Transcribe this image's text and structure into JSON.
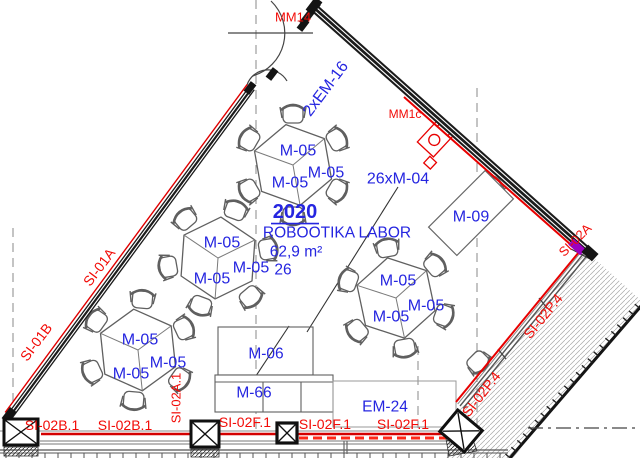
{
  "drawing_type": "architectural-floor-plan",
  "room": {
    "number": "2020",
    "name": "ROBOOTIKA LABOR",
    "area": "62,9 m²",
    "capacity": "26"
  },
  "colors": {
    "blue": "#2525e0",
    "red": "#f20b07",
    "redline": "#e00000",
    "wall": "#1b1b1b",
    "thin": "#5f5f5f",
    "grid": "#8a8a8a",
    "purple": "#9b00c0"
  },
  "labels": [
    {
      "text": "MM14",
      "x": 293,
      "y": 17,
      "rot": 0,
      "color": "red",
      "size": 13
    },
    {
      "text": "2xEM-16",
      "x": 326,
      "y": 89,
      "rot": -53,
      "color": "blue",
      "size": 16
    },
    {
      "text": "MM1c",
      "x": 405,
      "y": 114,
      "rot": 0,
      "color": "red",
      "size": 12
    },
    {
      "text": "M-05",
      "x": 298,
      "y": 151,
      "rot": 0,
      "color": "blue",
      "size": 16
    },
    {
      "text": "M-05",
      "x": 326,
      "y": 173,
      "rot": 0,
      "color": "blue",
      "size": 16
    },
    {
      "text": "M-05",
      "x": 290,
      "y": 183,
      "rot": 0,
      "color": "blue",
      "size": 16
    },
    {
      "text": "26xM-04",
      "x": 398,
      "y": 179,
      "rot": 0,
      "color": "blue",
      "size": 16
    },
    {
      "text": "M-09",
      "x": 471,
      "y": 217,
      "rot": 0,
      "color": "blue",
      "size": 16
    },
    {
      "text": "2020",
      "x": 295,
      "y": 212,
      "rot": 0,
      "color": "blue",
      "size": 20,
      "bold": true,
      "underline": true
    },
    {
      "text": "ROBOOTIKA LABOR",
      "x": 337,
      "y": 233,
      "rot": 0,
      "color": "blue",
      "size": 15.5
    },
    {
      "text": "62,9 m²",
      "x": 296,
      "y": 252,
      "rot": 0,
      "color": "blue",
      "size": 15.5
    },
    {
      "text": "26",
      "x": 283,
      "y": 270,
      "rot": 0,
      "color": "blue",
      "size": 15.5
    },
    {
      "text": "SI-02A",
      "x": 575,
      "y": 240,
      "rot": -45,
      "color": "red",
      "size": 13
    },
    {
      "text": "SI-01A",
      "x": 99,
      "y": 267,
      "rot": -53,
      "color": "red",
      "size": 14
    },
    {
      "text": "SI-01B",
      "x": 36,
      "y": 342,
      "rot": -53,
      "color": "red",
      "size": 14
    },
    {
      "text": "M-05",
      "x": 222,
      "y": 243,
      "rot": 0,
      "color": "blue",
      "size": 16
    },
    {
      "text": "M-05",
      "x": 251,
      "y": 268,
      "rot": 0,
      "color": "blue",
      "size": 16
    },
    {
      "text": "M-05",
      "x": 212,
      "y": 279,
      "rot": 0,
      "color": "blue",
      "size": 16
    },
    {
      "text": "M-05",
      "x": 398,
      "y": 281,
      "rot": 0,
      "color": "blue",
      "size": 16
    },
    {
      "text": "M-05",
      "x": 426,
      "y": 306,
      "rot": 0,
      "color": "blue",
      "size": 16
    },
    {
      "text": "M-05",
      "x": 391,
      "y": 317,
      "rot": 0,
      "color": "blue",
      "size": 16
    },
    {
      "text": "M-05",
      "x": 140,
      "y": 340,
      "rot": 0,
      "color": "blue",
      "size": 16
    },
    {
      "text": "M-05",
      "x": 168,
      "y": 363,
      "rot": 0,
      "color": "blue",
      "size": 16
    },
    {
      "text": "M-05",
      "x": 131,
      "y": 374,
      "rot": 0,
      "color": "blue",
      "size": 16
    },
    {
      "text": "SI-02P.4",
      "x": 543,
      "y": 316,
      "rot": -51,
      "color": "red",
      "size": 14
    },
    {
      "text": "SI-02P.4",
      "x": 481,
      "y": 394,
      "rot": -52,
      "color": "red",
      "size": 14
    },
    {
      "text": "M-06",
      "x": 266,
      "y": 354,
      "rot": 0,
      "color": "blue",
      "size": 15.5
    },
    {
      "text": "M-66",
      "x": 254,
      "y": 393,
      "rot": 0,
      "color": "blue",
      "size": 15.5
    },
    {
      "text": "EM-24",
      "x": 385,
      "y": 407,
      "rot": 0,
      "color": "blue",
      "size": 15.5
    },
    {
      "text": "SI-02B.1",
      "x": 52,
      "y": 425,
      "rot": 0,
      "color": "red",
      "size": 14
    },
    {
      "text": "SI-02B.1",
      "x": 125,
      "y": 425,
      "rot": 0,
      "color": "red",
      "size": 14
    },
    {
      "text": "SI-02A.1",
      "x": 176,
      "y": 398,
      "rot": -90,
      "color": "red",
      "size": 13
    },
    {
      "text": "SI-02F.1",
      "x": 245,
      "y": 422,
      "rot": 0,
      "color": "red",
      "size": 14
    },
    {
      "text": "SI-02F.1",
      "x": 325,
      "y": 424,
      "rot": 0,
      "color": "red",
      "size": 14
    },
    {
      "text": "SI-02F.1",
      "x": 403,
      "y": 424,
      "rot": 0,
      "color": "red",
      "size": 14
    }
  ]
}
